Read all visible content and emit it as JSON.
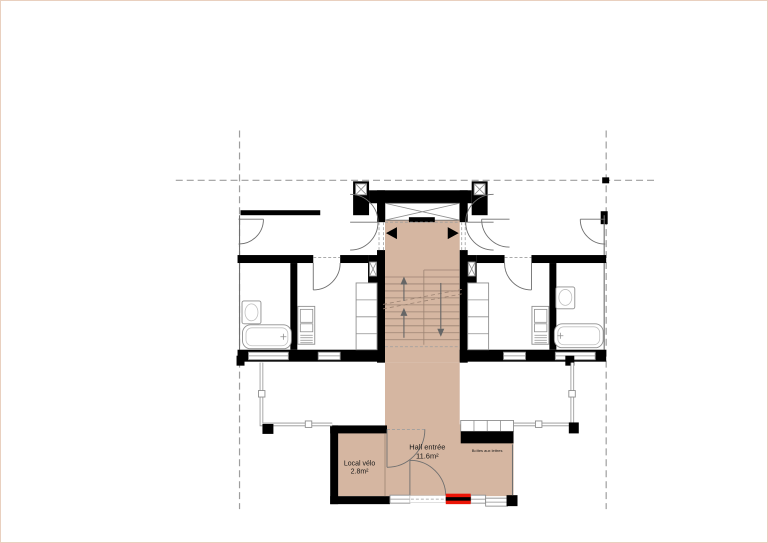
{
  "plan": {
    "type": "architectural-floor-plan",
    "rooms": {
      "hall": {
        "label": "Hall entrée",
        "area": "11.6m²"
      },
      "bike": {
        "label": "Local vélo",
        "area": "2.8m²"
      },
      "mailbox": {
        "label": "Boîtes aux lettres"
      }
    },
    "colors": {
      "background": "#ffffff",
      "page_border": "#e9d0bf",
      "wall": "#000000",
      "hall_fill": "#d5b6a1",
      "guide_line": "#9e9e9e",
      "detail_line": "#6f6f6f",
      "fixture_line": "#8f8f8f",
      "stair_line": "#9c8373",
      "entrance_red": "#ec1507",
      "label_text": "#1a1a1a"
    }
  }
}
